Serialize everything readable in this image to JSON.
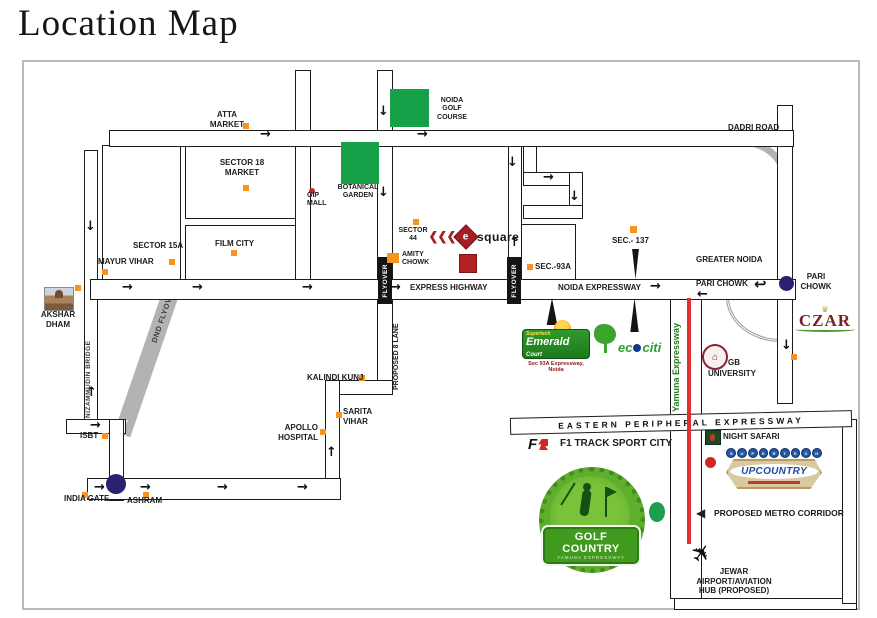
{
  "title": "Location Map",
  "icons": {
    "arrow_right": "→",
    "arrow_left": "←",
    "arrow_up": "↑",
    "arrow_down": "↓",
    "u_turn": "↩",
    "plane": "✈",
    "metro_arrow": "◀",
    "crown": "♛",
    "dome": "⌂"
  },
  "colors": {
    "marker_orange": "#F7941D",
    "patch_green": "#16A048",
    "junction_navy": "#2B2171",
    "metro_red": "#E03131",
    "czar_maroon": "#7B1F24",
    "upcountry_blue": "#1B4E9B"
  },
  "map": {
    "labels": {
      "atta": "ATTA\nMARKET",
      "sector18": "SECTOR 18\nMARKET",
      "gip": "GIP\nMALL",
      "botanical": "BOTANICAL\nGARDEN",
      "noida_golf": "NOIDA\nGOLF\nCOURSE",
      "dadri": "DADRI ROAD",
      "sector15a": "SECTOR 15A",
      "mayur": "MAYUR VIHAR",
      "film_city": "FILM CITY",
      "sector44": "SECTOR\n44",
      "amity": "AMITY\nCHOWK",
      "sec93a": "SEC.-93A",
      "sec137": "SEC.- 137",
      "greater_noida": "GREATER NOIDA",
      "pari_chowk_road": "PARI CHOWK",
      "pari_chowk_junction": "PARI\nCHOWK",
      "express_highway": "EXPRESS HIGHWAY",
      "noida_expressway": "NOIDA EXPRESSWAY",
      "akshar_dham": "AKSHAR\nDHAM",
      "nizammudin": "NIZAMMUDIN BRIDGE",
      "dnd": "DND FLYOVER",
      "flyover": "FLYOVER",
      "proposed_8_lane": "PROPOSED 8 LANE",
      "kalindi": "KALINDI KUNJ",
      "sarita": "SARITA\nVIHAR",
      "apollo": "APOLLO\nHOSPITAL",
      "isbt": "ISBT",
      "india_gate": "INDIA GATE",
      "ashram": "ASHRAM",
      "eastern": "EASTERN PERIPHERAL EXPRESSWAY",
      "f1_track": "F1 TRACK SPORT CITY",
      "night_safari": "NIGHT SAFARI",
      "metro": "PROPOSED METRO CORRIDOR",
      "jewar": "JEWAR\nAIRPORT/AVIATION\nHUB (PROPOSED)",
      "yamuna": "Yamuna Expressway",
      "gb": "GB",
      "university": "UNIVERSITY"
    },
    "logos": {
      "esquare": {
        "e": "e",
        "name": "square"
      },
      "emerald": {
        "brand": "Supertech",
        "name": "Emerald",
        "suffix": "Court",
        "address": "Sec 93A Expressway, Noida"
      },
      "ecociti": {
        "prefix": "ec",
        "suffix": "citi"
      },
      "czar": {
        "name": "CZAR"
      },
      "golf_country": {
        "name": "GOLF COUNTRY",
        "tagline": "YAMUNA EXPRESSWAY"
      },
      "upcountry": {
        "name": "UPCOUNTRY",
        "bulbs": "SUPERTECH"
      },
      "f1": {
        "f": "F"
      }
    }
  }
}
